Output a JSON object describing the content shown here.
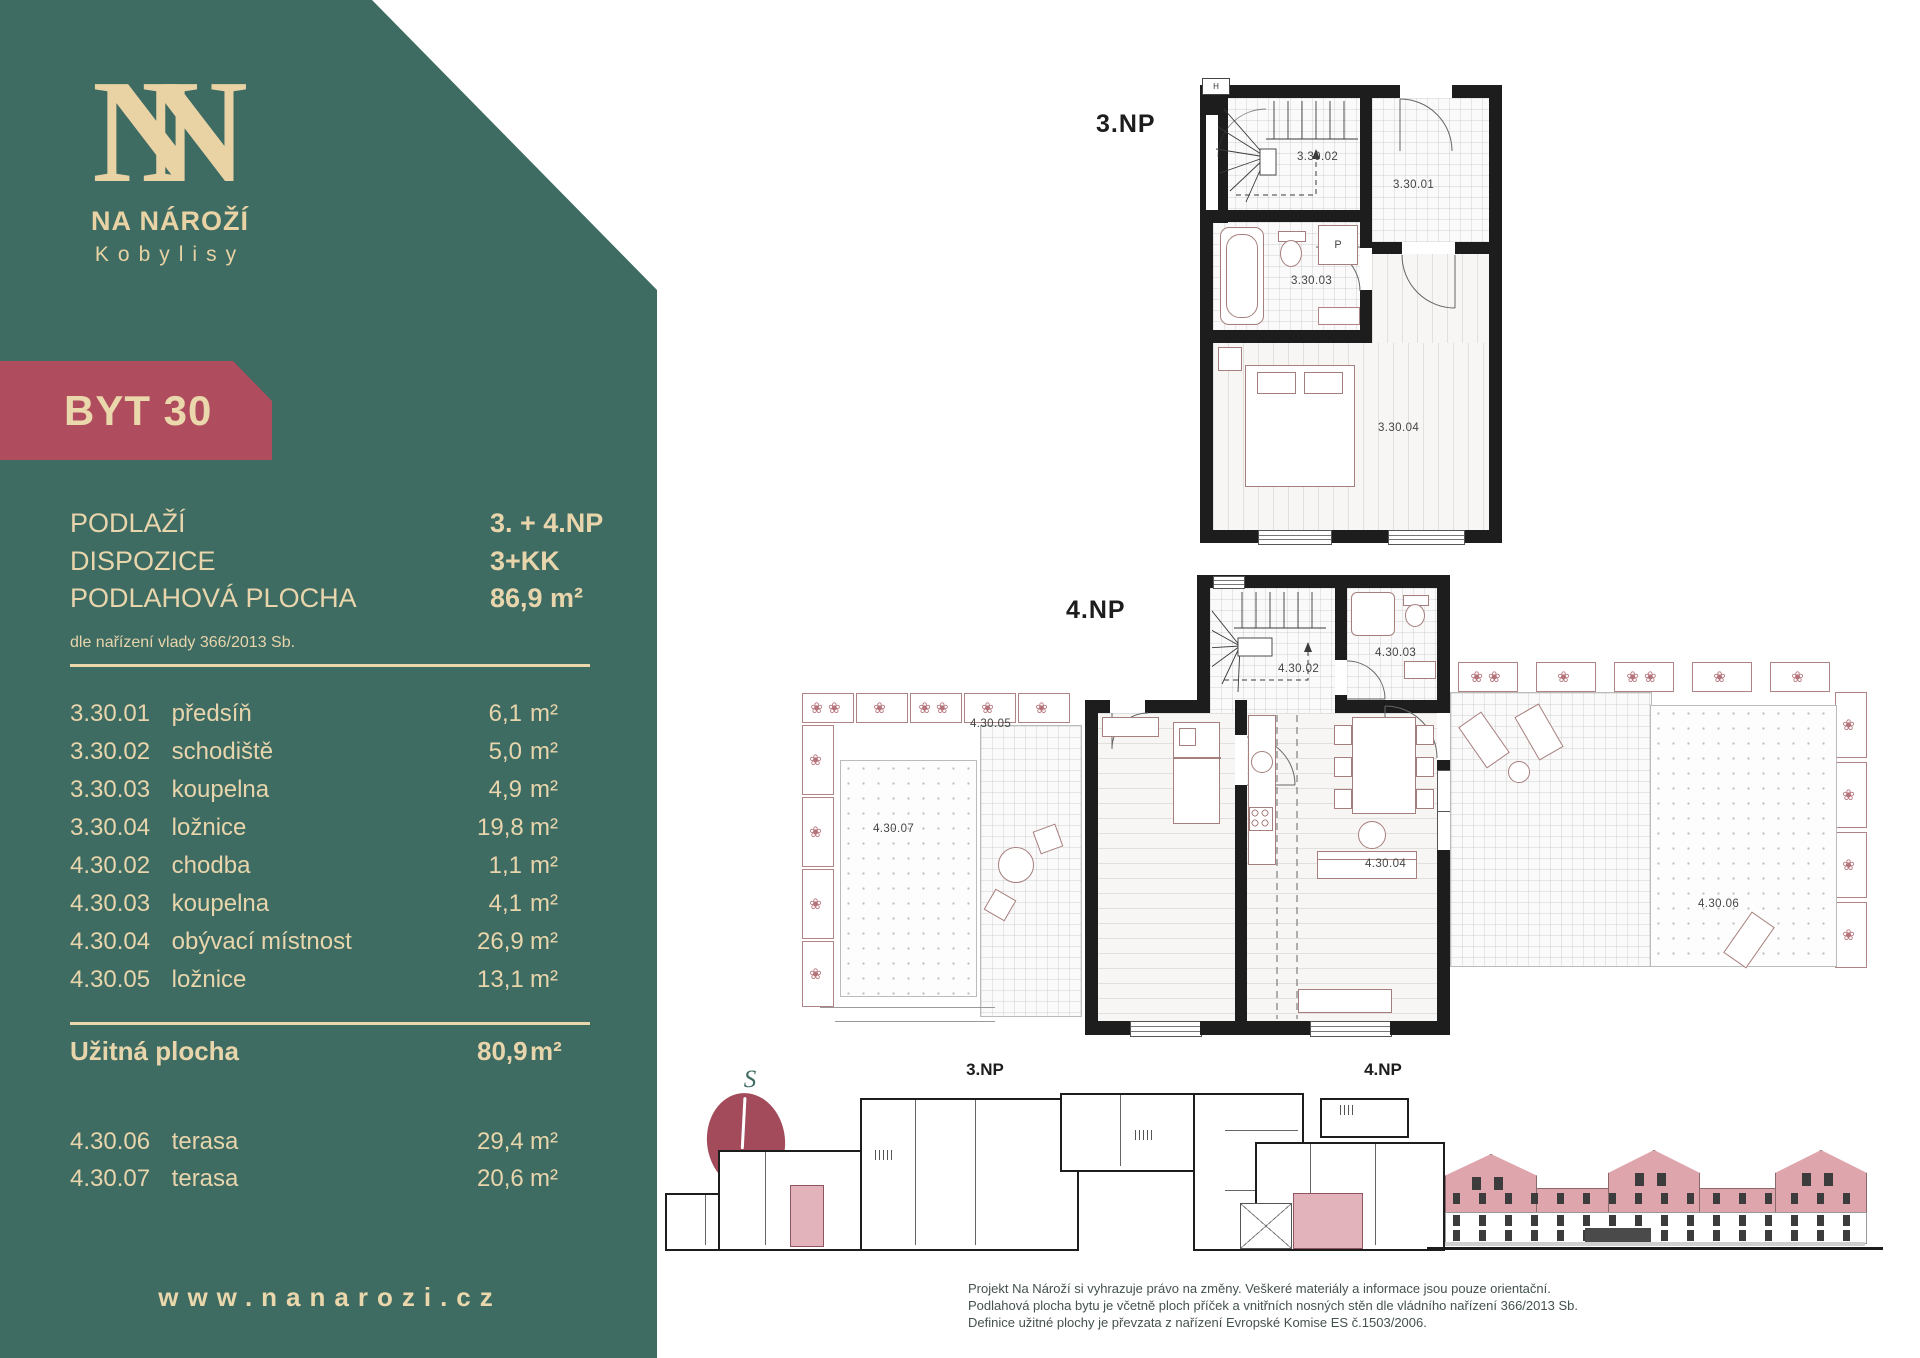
{
  "brand": {
    "monogram_left": "N",
    "monogram_right": "N",
    "name": "NA NÁROŽÍ",
    "city": "Kobylisy",
    "website": "www.nanarozi.cz"
  },
  "unit_badge": "BYT 30",
  "summary": {
    "rows": [
      {
        "label": "PODLAŽÍ",
        "value": "3. + 4.NP"
      },
      {
        "label": "DISPOZICE",
        "value": "3+KK"
      },
      {
        "label": "PODLAHOVÁ PLOCHA",
        "value": "86,9 m²"
      }
    ],
    "note": "dle nařízení vlady 366/2013 Sb."
  },
  "rooms": [
    {
      "code": "3.30.01",
      "name": "předsíň",
      "area": "6,1",
      "unit": "m²"
    },
    {
      "code": "3.30.02",
      "name": "schodiště",
      "area": "5,0",
      "unit": "m²"
    },
    {
      "code": "3.30.03",
      "name": "koupelna",
      "area": "4,9",
      "unit": "m²"
    },
    {
      "code": "3.30.04",
      "name": "ložnice",
      "area": "19,8",
      "unit": "m²"
    },
    {
      "code": "4.30.02",
      "name": "chodba",
      "area": "1,1",
      "unit": "m²"
    },
    {
      "code": "4.30.03",
      "name": "koupelna",
      "area": "4,1",
      "unit": "m²"
    },
    {
      "code": "4.30.04",
      "name": "obývací místnost",
      "area": "26,9",
      "unit": "m²"
    },
    {
      "code": "4.30.05",
      "name": "ložnice",
      "area": "13,1",
      "unit": "m²"
    }
  ],
  "useful_area": {
    "label": "Užitná plocha",
    "area": "80,9",
    "unit": "m²"
  },
  "terraces": [
    {
      "code": "4.30.06",
      "name": "terasa",
      "area": "29,4",
      "unit": "m²"
    },
    {
      "code": "4.30.07",
      "name": "terasa",
      "area": "20,6",
      "unit": "m²"
    }
  ],
  "plan3": {
    "title": "3.NP",
    "labels": {
      "hall": "3.30.01",
      "stairs": "3.30.02",
      "bath": "3.30.03",
      "bedroom": "3.30.04",
      "washer": "P",
      "h_mark": "H"
    }
  },
  "plan4": {
    "title": "4.NP",
    "labels": {
      "corridor": "4.30.02",
      "bath": "4.30.03",
      "living": "4.30.04",
      "bedroom": "4.30.05",
      "terrace_right": "4.30.06",
      "terrace_left": "4.30.07"
    }
  },
  "overview": {
    "compass": "S",
    "plan3_title": "3.NP",
    "plan4_title": "4.NP"
  },
  "glyphs": {
    "flower": "❀"
  },
  "disclaimer": {
    "line1": "Projekt Na Nároží si vyhrazuje právo na změny. Veškeré materiály a informace jsou pouze orientační.",
    "line2": "Podlahová plocha bytu je včetně ploch příček a vnitřních nosných stěn dle vládního nařízení 366/2013 Sb.",
    "line3": "Definice užitné plochy je převzata z nařízení Evropské Komise ES č.1503/2006."
  },
  "colors": {
    "teal": "#3E6B62",
    "cream": "#EBD7AC",
    "ribbon_red": "#AF4C5E",
    "highlight_pink": "#E3B3BB",
    "wall_black": "#1D1D1D"
  }
}
